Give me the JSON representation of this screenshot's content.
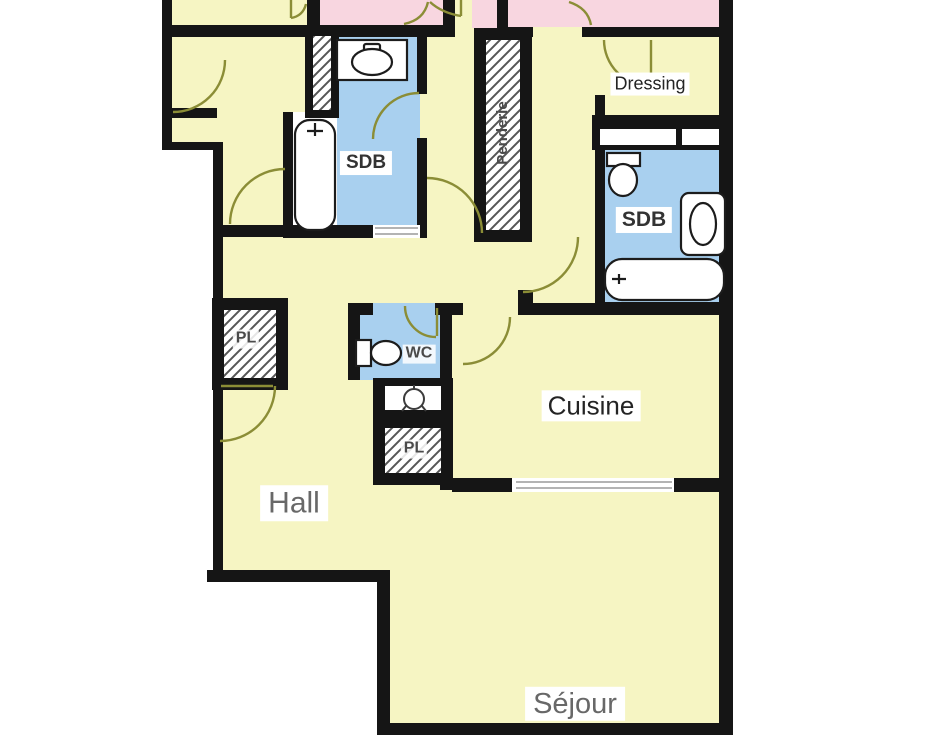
{
  "rooms": {
    "hall": {
      "label": "Hall"
    },
    "sejour": {
      "label": "Séjour"
    },
    "cuisine": {
      "label": "Cuisine"
    },
    "dressing": {
      "label": "Dressing"
    },
    "sdb_left": {
      "label": "SDB"
    },
    "sdb_right": {
      "label": "SDB"
    },
    "wc": {
      "label": "WC"
    },
    "penderie": {
      "label": "Penderie"
    },
    "pl_left": {
      "label": "PL"
    },
    "pl_center": {
      "label": "PL"
    }
  },
  "colors": {
    "room_fill": "#f6f5c3",
    "bedroom_fill": "#f8d6e0",
    "wet_room_fill": "#a9d0ef",
    "wall": "#151515",
    "door_arc": "#8b8d36",
    "hatch_line": "#565656",
    "label_dark": "#242424",
    "label_gray": "#686868"
  },
  "icons": {
    "bathtub": "rounded-rect-outline",
    "toilet": "tank-and-bowl",
    "washbasin": "oval-basin",
    "water_heater": "circle-glyph",
    "closet": "diagonal-hatch"
  }
}
